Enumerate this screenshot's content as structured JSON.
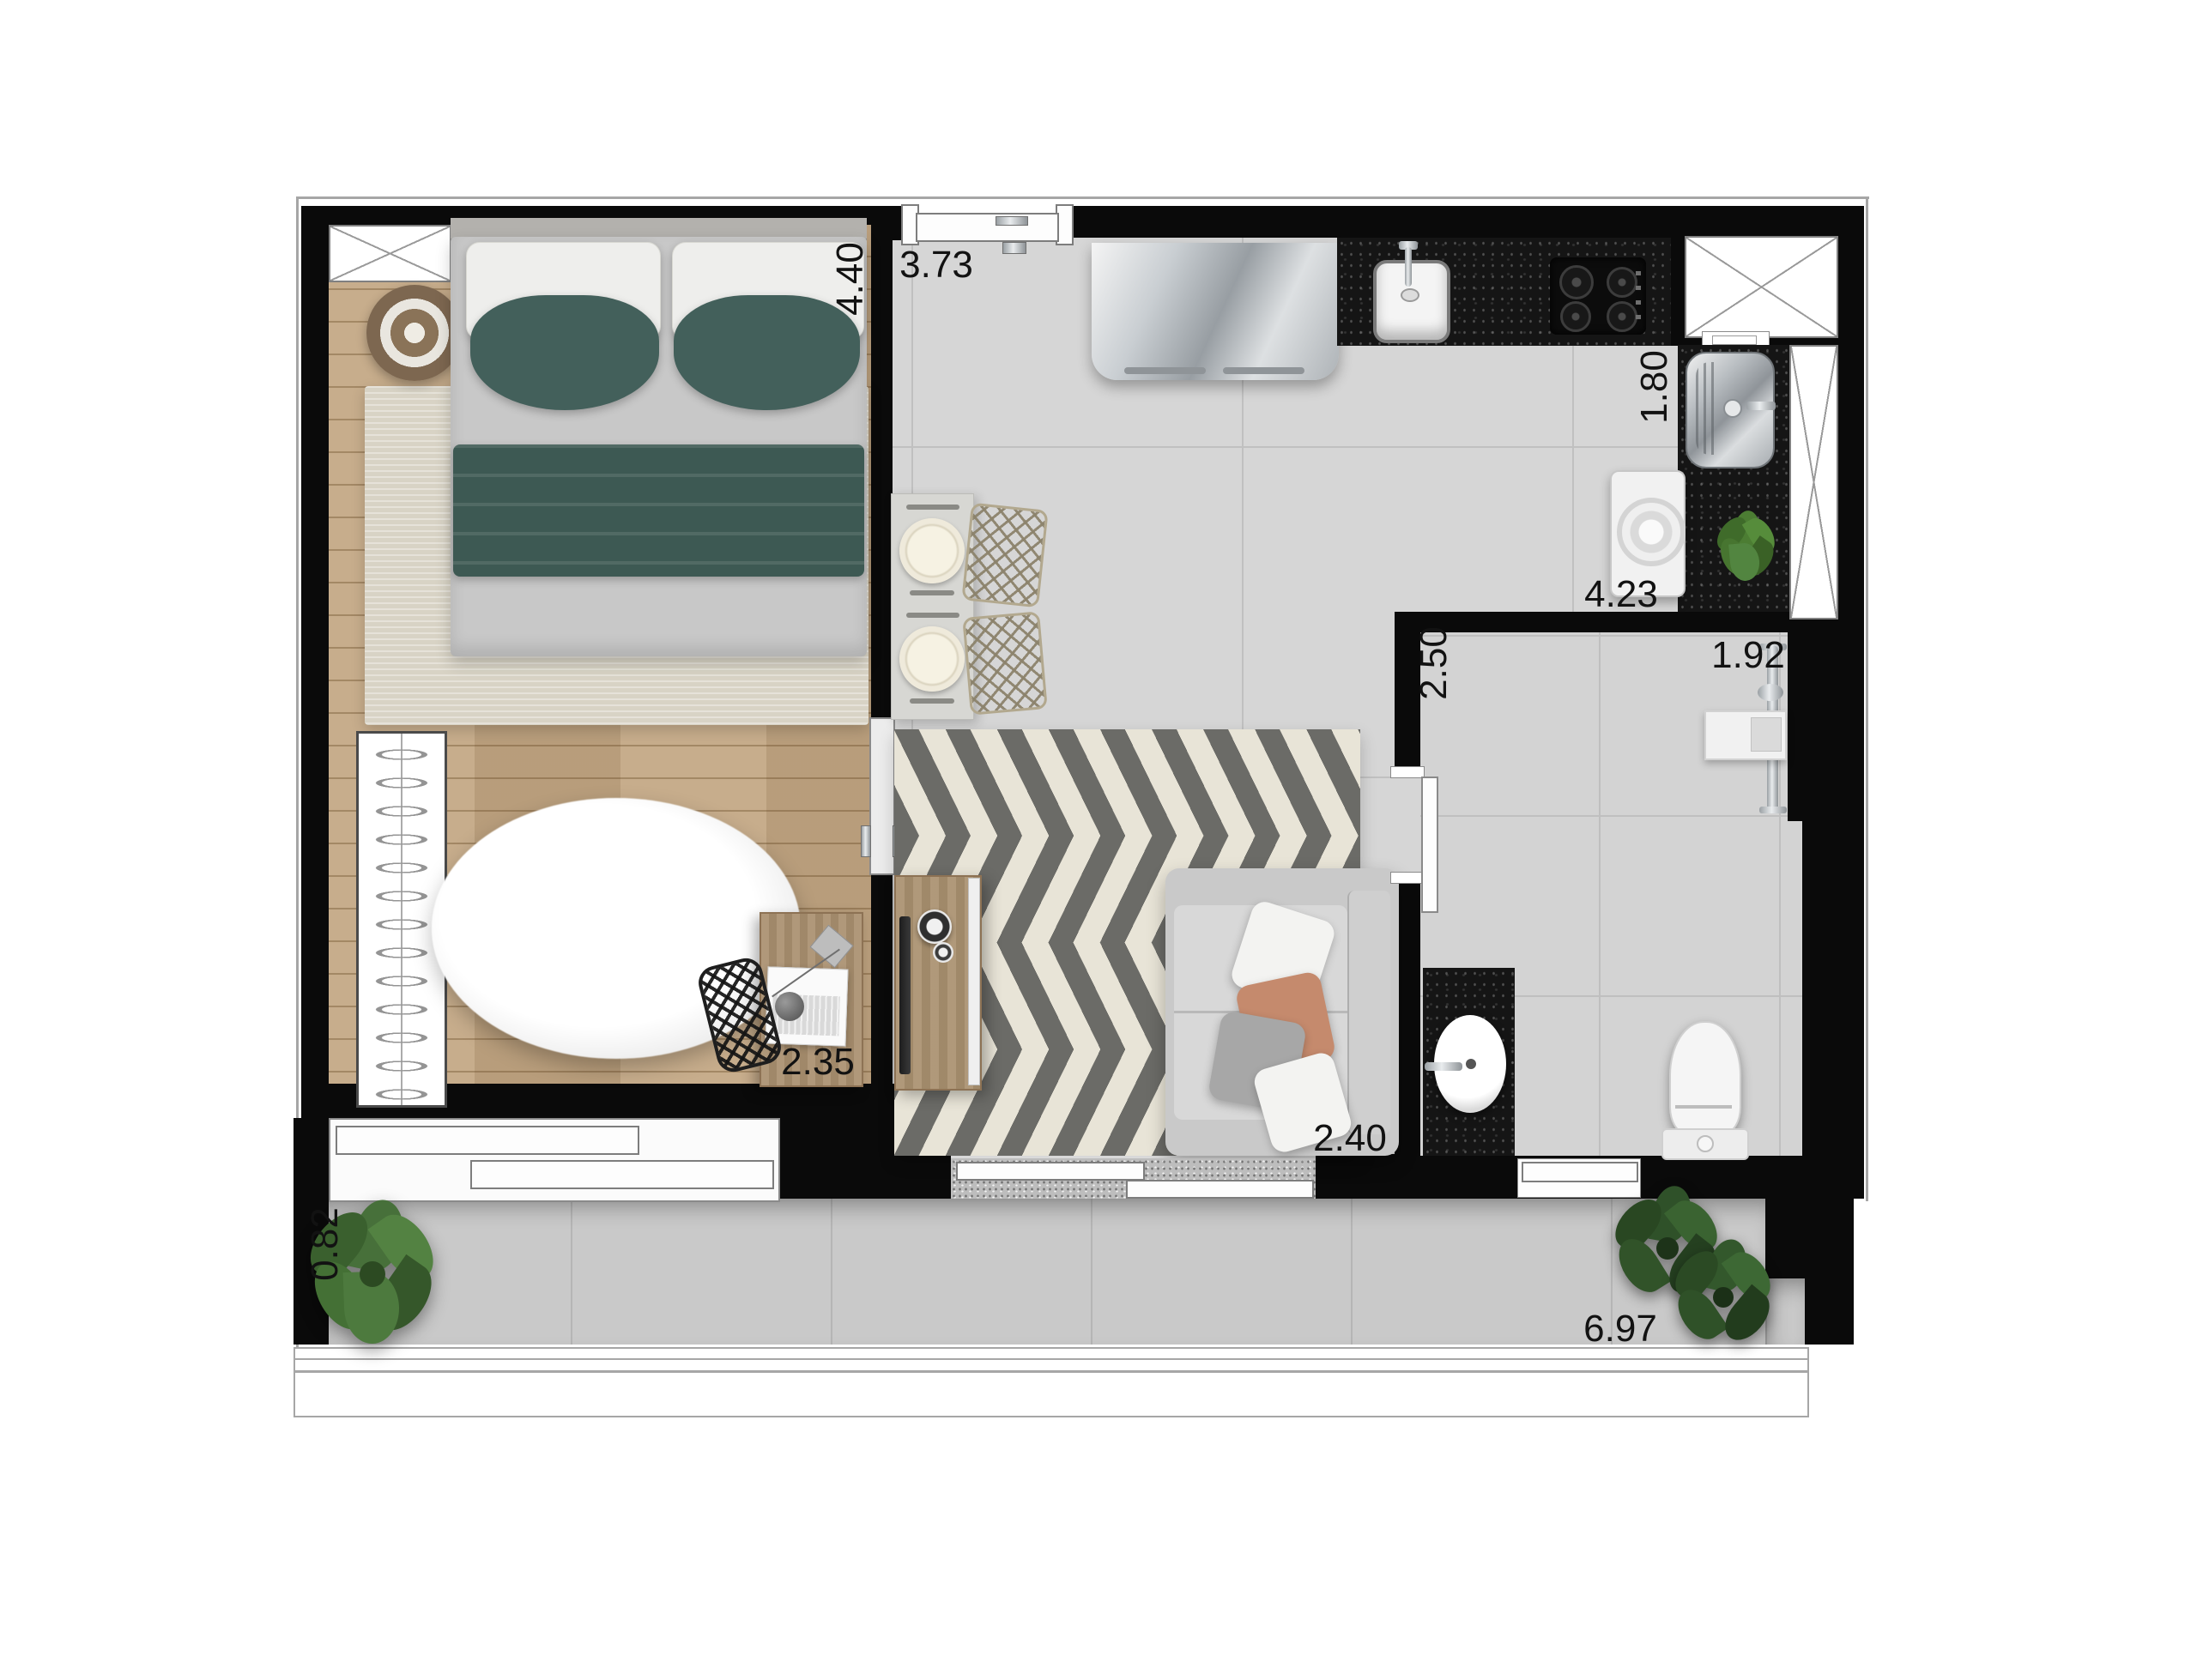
{
  "plan": {
    "type": "apartment-floor-plan-top-view",
    "dimension_labels": [
      {
        "text": "4.40",
        "orientation": "vertical"
      },
      {
        "text": "3.73",
        "orientation": "horizontal"
      },
      {
        "text": "1.80",
        "orientation": "vertical"
      },
      {
        "text": "4.23",
        "orientation": "horizontal"
      },
      {
        "text": "2.50",
        "orientation": "vertical"
      },
      {
        "text": "1.92",
        "orientation": "horizontal"
      },
      {
        "text": "2.35",
        "orientation": "horizontal"
      },
      {
        "text": "2.40",
        "orizontal": "horizontal"
      },
      {
        "text": "0.82",
        "orientation": "vertical"
      },
      {
        "text": "6.97",
        "orientation": "horizontal"
      }
    ],
    "furniture_visible": [
      "double-bed-with-teal-pillows-and-blanket",
      "round-side-table",
      "bedroom-area-rug",
      "wardrobe-with-hangers",
      "round-fur-rug",
      "desk-with-laptop",
      "geometric-desk-chair",
      "sliding-door-bedroom",
      "entry-door",
      "refrigerator",
      "kitchen-counter-granite",
      "kitchen-sink",
      "cooktop-4-burners",
      "dining-table-for-two",
      "wire-chairs",
      "chevron-area-rug",
      "tv-console",
      "sofa-with-pillows",
      "laundry-tank",
      "washing-machine",
      "service-counter-plant",
      "bathroom-vanity",
      "oval-basin",
      "toilet",
      "shower-rail",
      "shower-shelf",
      "balcony-monstera-plant",
      "balcony-plants",
      "balcony-railing",
      "shaft-box-x",
      "duct-column-x"
    ],
    "palette": {
      "wall": "#0a0a0a",
      "teal_bedding": "#405c57",
      "wood": "#c3a783",
      "tile_gray": "#d6d6d6",
      "granite_dark": "#151515",
      "rug_cream": "#e8e4d7",
      "rug_stripe": "#6b6b67",
      "plant_green": "#47703a",
      "sofa_gray": "#cecece",
      "accent_orange": "#c58a6d"
    }
  }
}
